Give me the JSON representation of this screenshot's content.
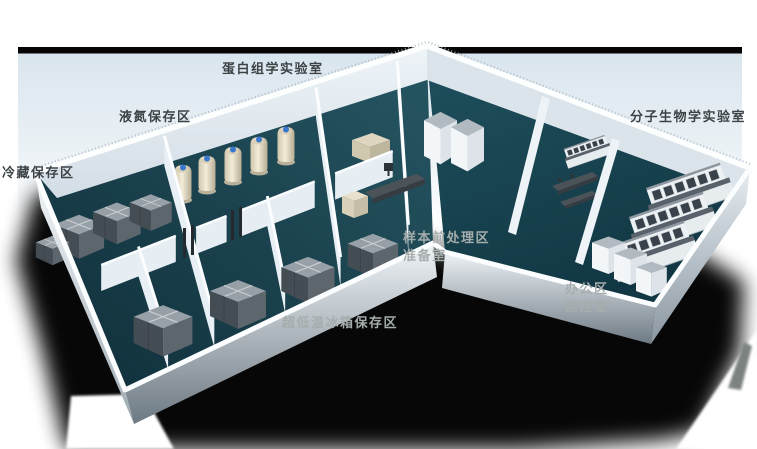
{
  "figure": {
    "kind": "3d-isometric-laboratory-floorplan-render",
    "area_labels": {
      "proteomics_lab": "蛋白组学实验室",
      "liquid_nitrogen_storage": "液氮保存区",
      "cold_storage": "冷藏保存区",
      "molecular_biology_lab": "分子生物学实验室",
      "sample_pretreatment_area": "样本前处理区",
      "preparation_room": "准备室",
      "office_area": "办公区",
      "monitoring_room": "监控室",
      "ult_freezer_storage": "超低温冰箱保存区"
    },
    "palette": {
      "background": "#ffffff",
      "backdrop_top": "#dbe6ee",
      "top_stripe": "#050505",
      "floor_teal": "#1c4a58",
      "wall_light": "#f2f6f9",
      "shadow": "#000000",
      "label_dark": "#3b4347",
      "label_light": "#a6adad",
      "tank_body_cream": "#e9e1c9",
      "tank_cap_blue": "#3a77cf",
      "equipment_dark_gray": "#4e565c"
    }
  }
}
